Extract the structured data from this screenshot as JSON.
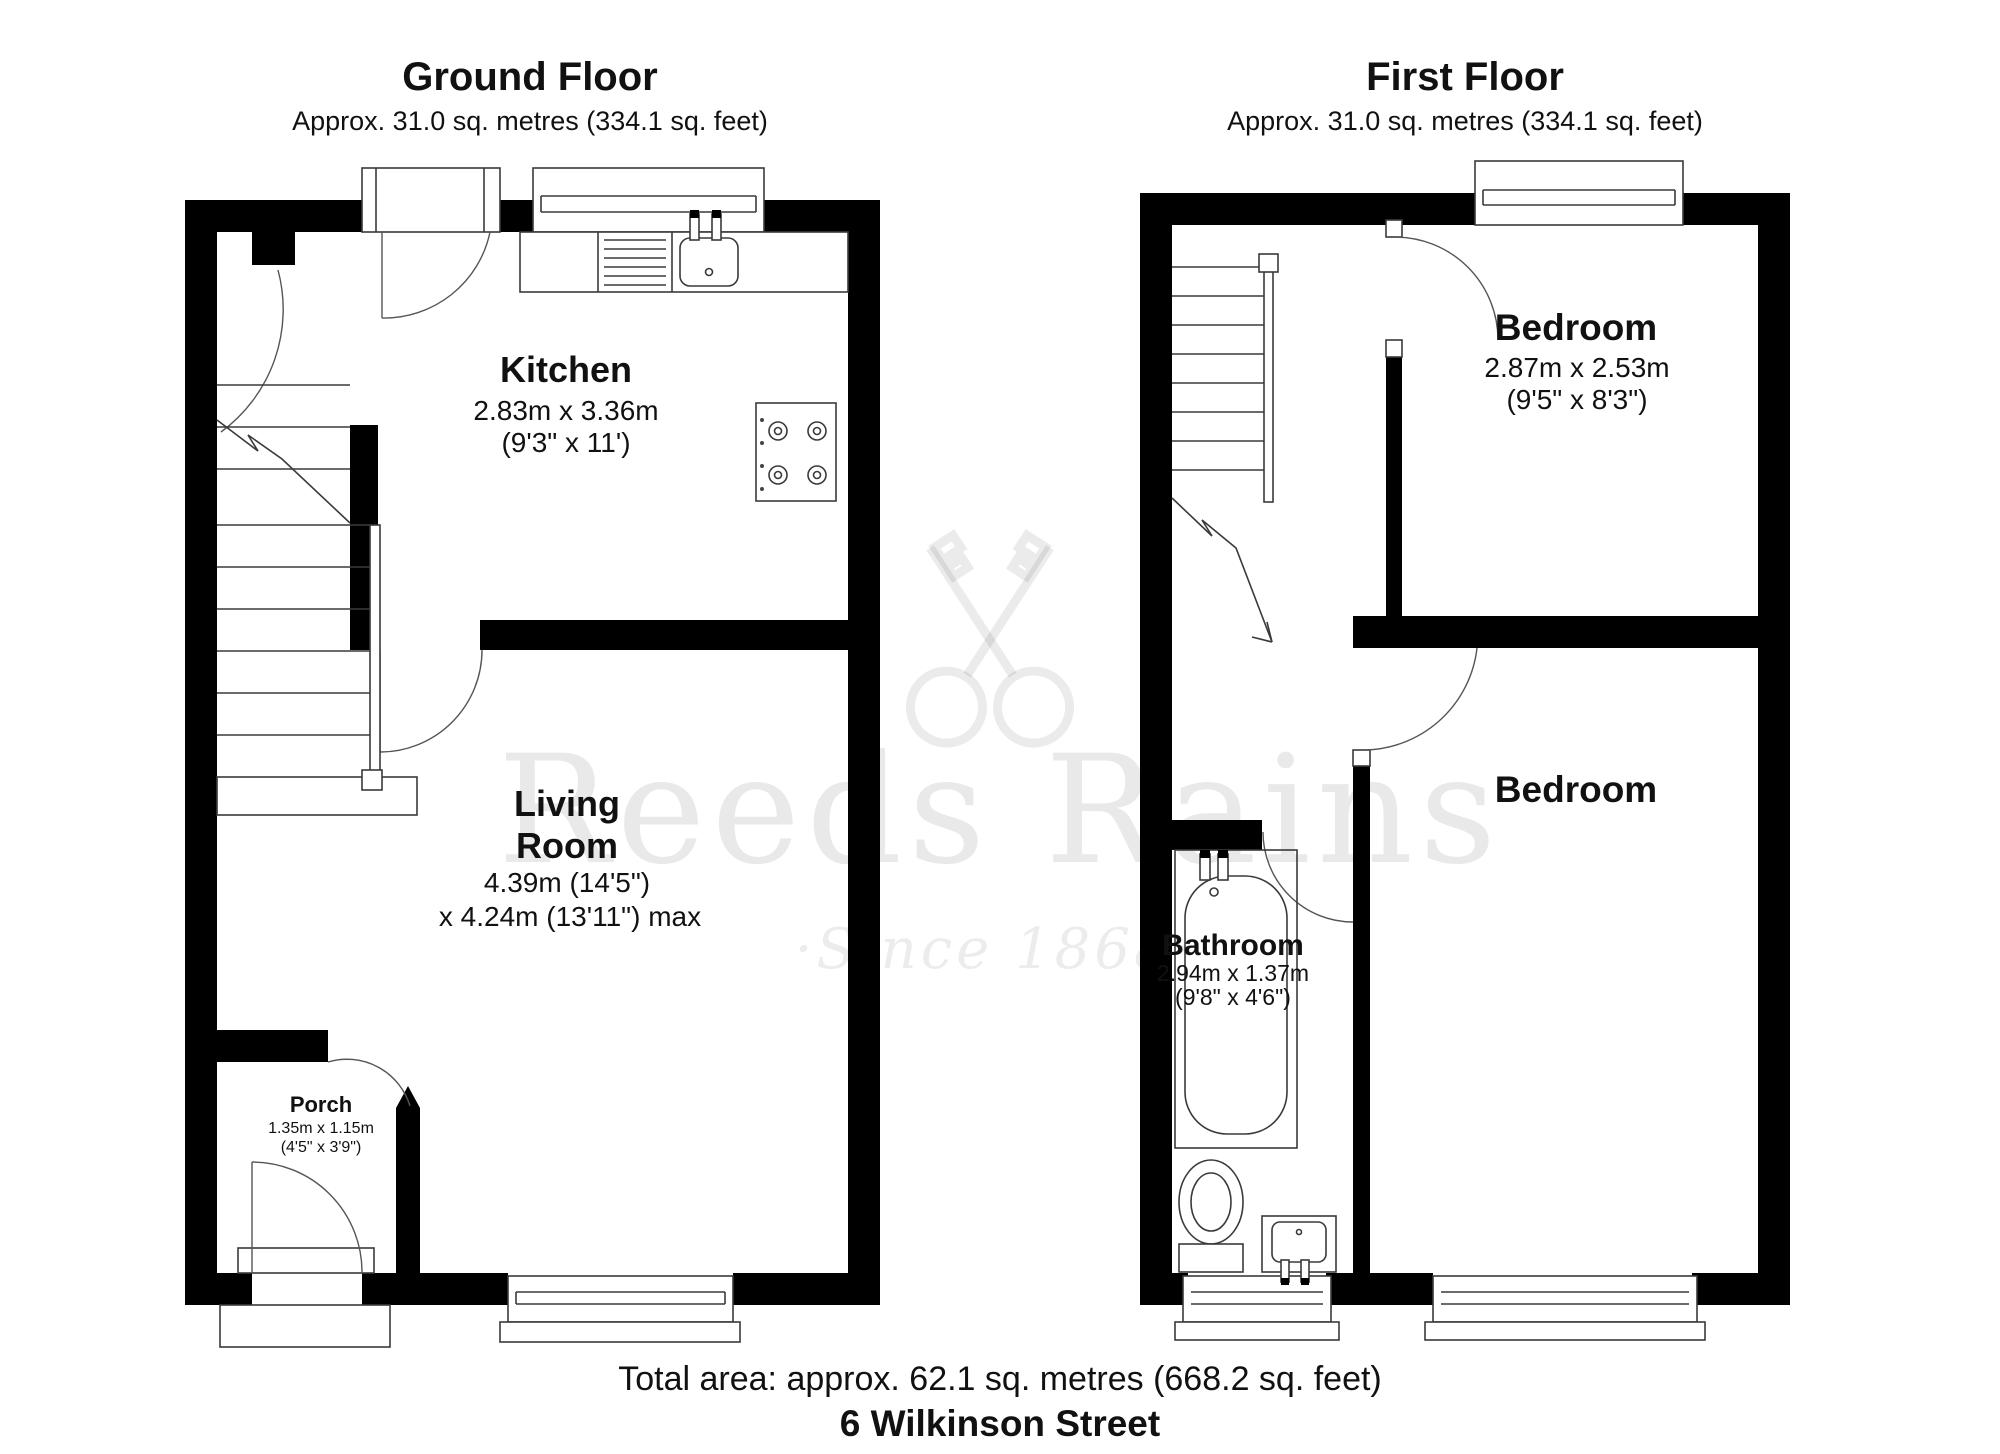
{
  "page": {
    "background": "#ffffff"
  },
  "ground_floor": {
    "title": "Ground Floor",
    "subtitle": "Approx. 31.0 sq. metres (334.1 sq. feet)",
    "kitchen": {
      "name": "Kitchen",
      "dims_metric": "2.83m x 3.36m",
      "dims_imperial": "(9'3\" x 11')"
    },
    "living_room": {
      "name_line1": "Living",
      "name_line2": "Room",
      "dims_line1": "4.39m (14'5\")",
      "dims_line2": "x 4.24m (13'11\") max"
    },
    "porch": {
      "name": "Porch",
      "dims_metric": "1.35m x 1.15m",
      "dims_imperial": "(4'5\" x 3'9\")"
    }
  },
  "first_floor": {
    "title": "First Floor",
    "subtitle": "Approx. 31.0 sq. metres (334.1 sq. feet)",
    "bedroom1": {
      "name": "Bedroom",
      "dims_metric": "2.87m x 2.53m",
      "dims_imperial": "(9'5\" x 8'3\")"
    },
    "bedroom2": {
      "name": "Bedroom"
    },
    "bathroom": {
      "name": "Bathroom",
      "dims_metric": "2.94m x 1.37m",
      "dims_imperial": "(9'8\" x 4'6\")"
    }
  },
  "footer": {
    "total_area": "Total area: approx. 62.1 sq. metres (668.2 sq. feet)",
    "address": "6 Wilkinson Street"
  },
  "watermark": {
    "brand": "Reeds Rains",
    "tagline": "·Since 1868·",
    "logo": "crossed-keys-icon"
  },
  "colors": {
    "wall": "#000000",
    "line": "#3a3a3a",
    "text": "#111111",
    "watermark_alpha": "rgba(0,0,0,0.08)"
  }
}
